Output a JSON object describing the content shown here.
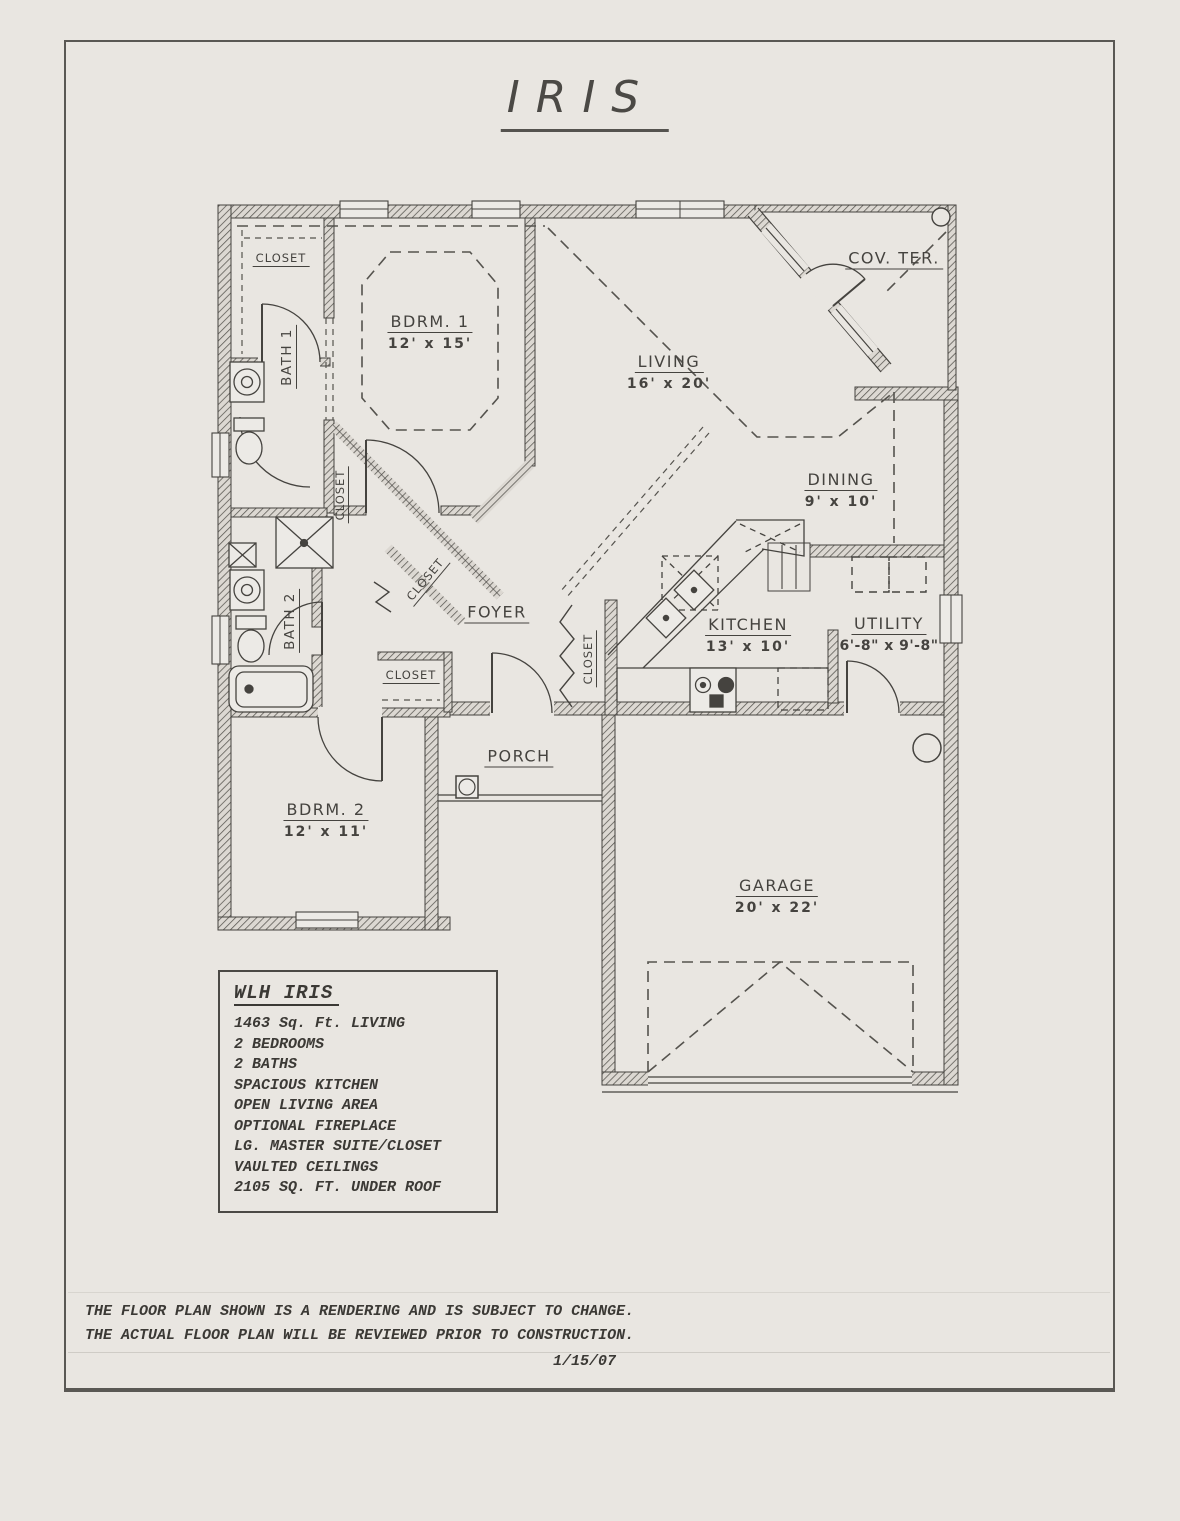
{
  "page": {
    "title": "IRIS",
    "date": "1/15/07",
    "disclaimer": [
      "THE FLOOR PLAN SHOWN IS A RENDERING AND IS SUBJECT TO CHANGE.",
      "THE ACTUAL FLOOR PLAN WILL BE REVIEWED PRIOR TO CONSTRUCTION."
    ]
  },
  "rooms": {
    "bdrm1": {
      "label": "BDRM. 1",
      "dims": "12' x 15'"
    },
    "living": {
      "label": "LIVING",
      "dims": "16' x 20'"
    },
    "cov_ter": {
      "label": "COV. TER."
    },
    "dining": {
      "label": "DINING",
      "dims": "9' x 10'"
    },
    "kitchen": {
      "label": "KITCHEN",
      "dims": "13' x 10'"
    },
    "utility": {
      "label": "UTILITY",
      "dims": "6'-8\" x 9'-8\""
    },
    "foyer": {
      "label": "FOYER"
    },
    "porch": {
      "label": "PORCH"
    },
    "bdrm2": {
      "label": "BDRM. 2",
      "dims": "12' x 11'"
    },
    "garage": {
      "label": "GARAGE",
      "dims": "20' x 22'"
    },
    "bath1": {
      "label": "BATH 1"
    },
    "bath2": {
      "label": "BATH 2"
    },
    "closet_master": {
      "label": "CLOSET"
    },
    "closet_hall": {
      "label": "CLOSET"
    },
    "closet_walkin": {
      "label": "CLOSET"
    },
    "closet_bdrm2": {
      "label": "CLOSET"
    },
    "closet_coat": {
      "label": "CLOSET"
    }
  },
  "info_box": {
    "title": "WLH IRIS",
    "lines": [
      "1463 Sq. Ft. LIVING",
      "2 BEDROOMS",
      "2 BATHS",
      "SPACIOUS KITCHEN",
      "OPEN LIVING AREA",
      "OPTIONAL FIREPLACE",
      "LG. MASTER SUITE/CLOSET",
      "VAULTED CEILINGS",
      "2105 SQ. FT. UNDER ROOF"
    ]
  },
  "colors": {
    "paper": "#e9e6e1",
    "ink": "#45433f"
  }
}
